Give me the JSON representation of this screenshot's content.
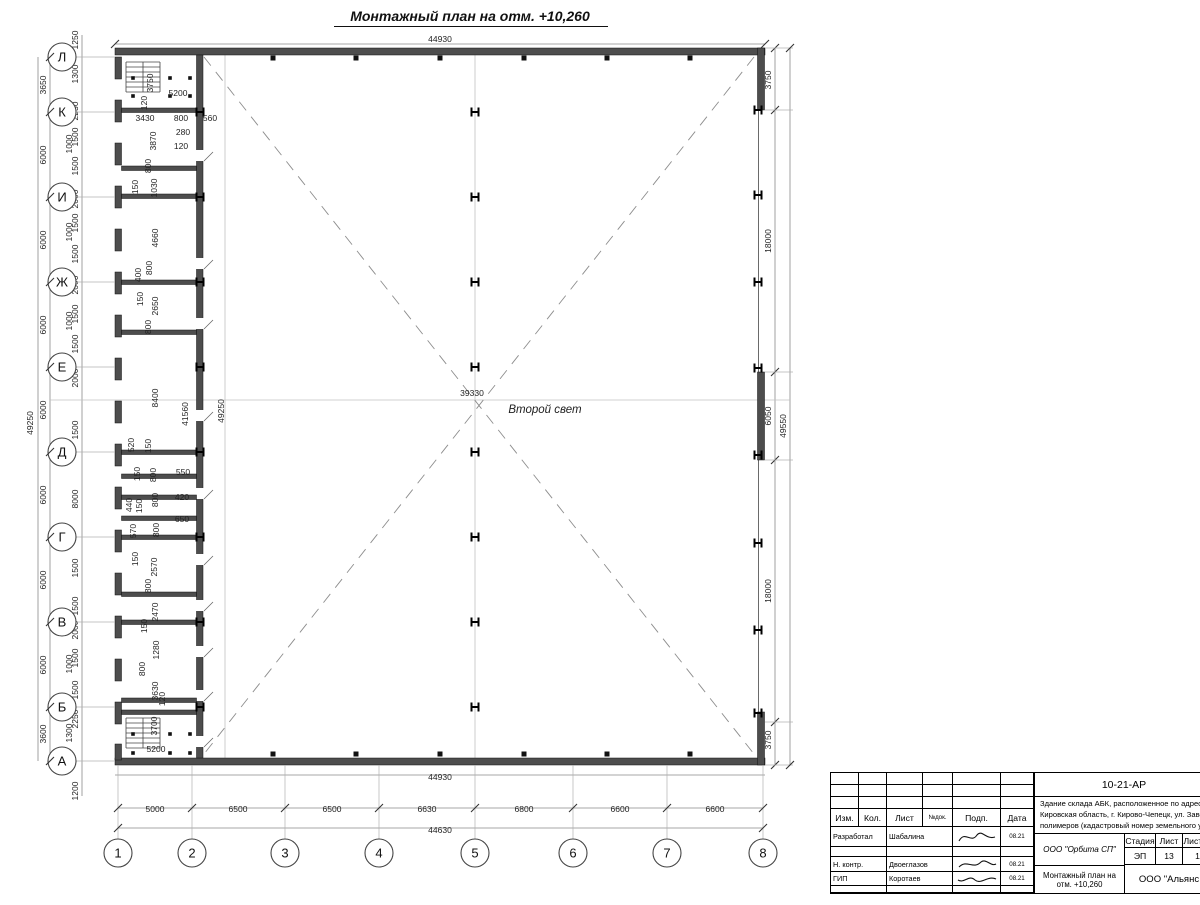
{
  "title": "Монтажный план на отм. +10,260",
  "plan": {
    "second_light": "Второй свет",
    "top_total": "44930",
    "bottom_wall_total": "44930",
    "bottom_total": "44630",
    "left_total": "49250",
    "right_total": "49550",
    "center_span": "39330",
    "inner_span_a": "41560",
    "inner_span_b": "49250"
  },
  "axes": {
    "left": [
      {
        "label": "Л",
        "y": 57
      },
      {
        "label": "К",
        "y": 112
      },
      {
        "label": "И",
        "y": 197
      },
      {
        "label": "Ж",
        "y": 282
      },
      {
        "label": "Е",
        "y": 367
      },
      {
        "label": "Д",
        "y": 452
      },
      {
        "label": "Г",
        "y": 537
      },
      {
        "label": "В",
        "y": 622
      },
      {
        "label": "Б",
        "y": 707
      },
      {
        "label": "А",
        "y": 761
      }
    ],
    "bottom": [
      {
        "label": "1",
        "x": 118
      },
      {
        "label": "2",
        "x": 192
      },
      {
        "label": "3",
        "x": 285
      },
      {
        "label": "4",
        "x": 379
      },
      {
        "label": "5",
        "x": 475
      },
      {
        "label": "6",
        "x": 573
      },
      {
        "label": "7",
        "x": 667
      },
      {
        "label": "8",
        "x": 763
      }
    ]
  },
  "dims": {
    "bottom_spacings": [
      {
        "t": "5000",
        "x": 155
      },
      {
        "t": "6500",
        "x": 238
      },
      {
        "t": "6500",
        "x": 332
      },
      {
        "t": "6630",
        "x": 427
      },
      {
        "t": "6800",
        "x": 524
      },
      {
        "t": "6600",
        "x": 620
      },
      {
        "t": "6600",
        "x": 715
      }
    ],
    "left_spacings": [
      {
        "t": "3650",
        "y": 85
      },
      {
        "t": "6000",
        "y": 155
      },
      {
        "t": "6000",
        "y": 240
      },
      {
        "t": "6000",
        "y": 325
      },
      {
        "t": "6000",
        "y": 410
      },
      {
        "t": "6000",
        "y": 495
      },
      {
        "t": "6000",
        "y": 580
      },
      {
        "t": "6000",
        "y": 665
      },
      {
        "t": "3600",
        "y": 734
      }
    ],
    "right_spacings": [
      {
        "t": "3750",
        "y": 80
      },
      {
        "t": "18000",
        "y": 241
      },
      {
        "t": "6050",
        "y": 416
      },
      {
        "t": "18000",
        "y": 591
      },
      {
        "t": "3750",
        "y": 740
      }
    ],
    "left_fine": [
      {
        "t": "1250",
        "y": 40
      },
      {
        "t": "1300",
        "y": 74
      },
      {
        "t": "2250",
        "y": 111
      },
      {
        "t": "1500",
        "y": 137
      },
      {
        "t": "1000",
        "y": 144,
        "x": 72
      },
      {
        "t": "1500",
        "y": 166
      },
      {
        "t": "2000",
        "y": 199
      },
      {
        "t": "1500",
        "y": 223
      },
      {
        "t": "1000",
        "y": 232,
        "x": 72
      },
      {
        "t": "1500",
        "y": 254
      },
      {
        "t": "2000",
        "y": 285
      },
      {
        "t": "1500",
        "y": 314
      },
      {
        "t": "1000",
        "y": 321,
        "x": 72
      },
      {
        "t": "1500",
        "y": 344
      },
      {
        "t": "2000",
        "y": 378
      },
      {
        "t": "1500",
        "y": 430
      },
      {
        "t": "8000",
        "y": 499
      },
      {
        "t": "1500",
        "y": 568
      },
      {
        "t": "1500",
        "y": 606
      },
      {
        "t": "2000",
        "y": 630
      },
      {
        "t": "1500",
        "y": 658
      },
      {
        "t": "1000",
        "y": 664,
        "x": 72
      },
      {
        "t": "1500",
        "y": 690
      },
      {
        "t": "2250",
        "y": 719
      },
      {
        "t": "1300",
        "y": 733,
        "x": 72
      },
      {
        "t": "1200",
        "y": 791
      }
    ],
    "inner": [
      {
        "t": "3750",
        "x": 153,
        "y": 83,
        "v": 1
      },
      {
        "t": "5200",
        "x": 178,
        "y": 96
      },
      {
        "t": "120",
        "x": 147,
        "y": 103,
        "v": 1
      },
      {
        "t": "3430",
        "x": 145,
        "y": 121
      },
      {
        "t": "800",
        "x": 181,
        "y": 121
      },
      {
        "t": "560",
        "x": 210,
        "y": 121
      },
      {
        "t": "280",
        "x": 183,
        "y": 135
      },
      {
        "t": "120",
        "x": 181,
        "y": 149
      },
      {
        "t": "3870",
        "x": 156,
        "y": 141,
        "v": 1
      },
      {
        "t": "800",
        "x": 151,
        "y": 166,
        "v": 1
      },
      {
        "t": "150",
        "x": 138,
        "y": 187,
        "v": 1
      },
      {
        "t": "1030",
        "x": 157,
        "y": 188,
        "v": 1
      },
      {
        "t": "4660",
        "x": 158,
        "y": 238,
        "v": 1
      },
      {
        "t": "800",
        "x": 152,
        "y": 268,
        "v": 1
      },
      {
        "t": "400",
        "x": 141,
        "y": 275,
        "v": 1
      },
      {
        "t": "150",
        "x": 143,
        "y": 299,
        "v": 1
      },
      {
        "t": "2650",
        "x": 158,
        "y": 306,
        "v": 1
      },
      {
        "t": "800",
        "x": 151,
        "y": 327,
        "v": 1
      },
      {
        "t": "8400",
        "x": 158,
        "y": 398,
        "v": 1
      },
      {
        "t": "520",
        "x": 134,
        "y": 445,
        "v": 1
      },
      {
        "t": "150",
        "x": 151,
        "y": 446,
        "v": 1
      },
      {
        "t": "150",
        "x": 140,
        "y": 474,
        "v": 1
      },
      {
        "t": "800",
        "x": 156,
        "y": 475,
        "v": 1
      },
      {
        "t": "550",
        "x": 183,
        "y": 475
      },
      {
        "t": "440",
        "x": 132,
        "y": 505,
        "v": 1
      },
      {
        "t": "150",
        "x": 142,
        "y": 506,
        "v": 1
      },
      {
        "t": "800",
        "x": 158,
        "y": 500,
        "v": 1
      },
      {
        "t": "420",
        "x": 182,
        "y": 500
      },
      {
        "t": "570",
        "x": 136,
        "y": 531,
        "v": 1
      },
      {
        "t": "800",
        "x": 159,
        "y": 530,
        "v": 1
      },
      {
        "t": "650",
        "x": 182,
        "y": 522
      },
      {
        "t": "150",
        "x": 138,
        "y": 559,
        "v": 1
      },
      {
        "t": "2570",
        "x": 157,
        "y": 567,
        "v": 1
      },
      {
        "t": "800",
        "x": 151,
        "y": 586,
        "v": 1
      },
      {
        "t": "2470",
        "x": 158,
        "y": 612,
        "v": 1
      },
      {
        "t": "150",
        "x": 147,
        "y": 626,
        "v": 1
      },
      {
        "t": "1280",
        "x": 159,
        "y": 650,
        "v": 1
      },
      {
        "t": "800",
        "x": 145,
        "y": 669,
        "v": 1
      },
      {
        "t": "3630",
        "x": 158,
        "y": 691,
        "v": 1
      },
      {
        "t": "120",
        "x": 165,
        "y": 699,
        "v": 1
      },
      {
        "t": "3700",
        "x": 157,
        "y": 726,
        "v": 1
      },
      {
        "t": "5200",
        "x": 156,
        "y": 752
      }
    ]
  },
  "stamp": {
    "code": "10-21-АР",
    "description_lines": [
      "Здание склада АБК, расположенное по адресу: Российская Феде",
      "Кировская область, г. Кирово-Чепецк, ул. Заводская, площадка з",
      "полимеров (кадастровый номер земельного участка 43:42:0000"
    ],
    "header_cols": [
      "Изм.",
      "Кол.",
      "Лист",
      "№док.",
      "Подп.",
      "Дата"
    ],
    "rows": [
      {
        "role": "Разработал",
        "name": "Шабалина",
        "date": "08.21"
      },
      {
        "role": "Н. контр.",
        "name": "Двоеглазов",
        "date": "08.21"
      },
      {
        "role": "ГИП",
        "name": "Коротаев",
        "date": "08.21"
      }
    ],
    "org1": "ООО \"Орбита СП\"",
    "stage_headers": [
      "Стадия",
      "Лист",
      "Листов"
    ],
    "stage_values": [
      "ЭП",
      "13",
      "1"
    ],
    "doc_title": "Монтажный план на отм. +10,260",
    "org2": "ООО \"Альянс"
  }
}
